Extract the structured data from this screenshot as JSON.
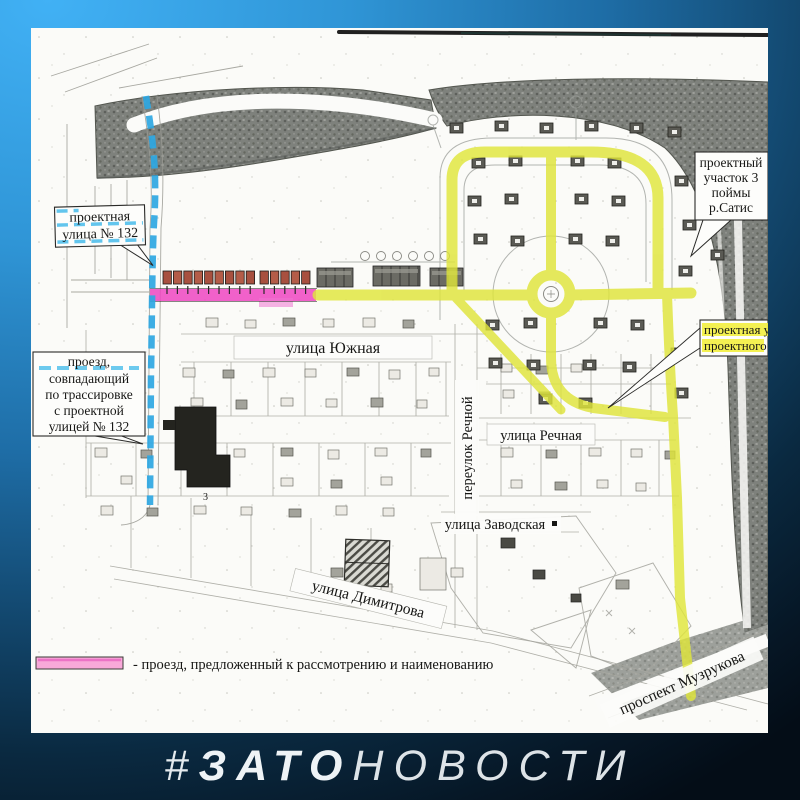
{
  "watermark": {
    "hash": "#",
    "bold": "ЗАТО",
    "light": "НОВОСТИ"
  },
  "legend": {
    "label": "- проезд, предложенный к рассмотрению и наименованию"
  },
  "callouts": {
    "project_street_132": {
      "line1": "проектная",
      "line2": "улица № 132"
    },
    "passage_matching": {
      "line1": "проезд,",
      "line2": "совпадающий",
      "line3": "по трассировке",
      "line4": "с проектной",
      "line5": "улицей № 132"
    },
    "project_site": {
      "line1": "проектный",
      "line2": "участок 3",
      "line3": "поймы",
      "line4": "р.Сатис"
    },
    "project_street_clipped": {
      "line1": "проектная у",
      "line2": "проектного"
    }
  },
  "streets": {
    "yuzhnaya": "улица Южная",
    "pereulok_rechnoy": "переулок Речной",
    "rechnaya": "улица Речная",
    "zavodskaya": "улица Заводская",
    "dimitrova": "улица Димитрова",
    "muzrukova": "проспект Музрукова"
  },
  "map_annotations": {
    "building_number": "3"
  },
  "colors": {
    "highlight_yellow": "#dfe53a",
    "highlight_pink": "#ee45c2",
    "highlight_blue": "#2ea7e2",
    "legend_pink": "#f8a9d9"
  }
}
